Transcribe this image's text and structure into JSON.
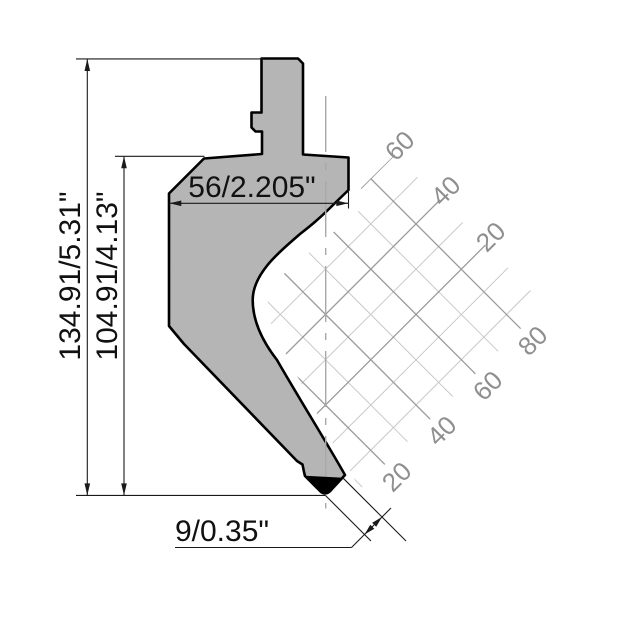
{
  "drawing": {
    "dims": {
      "total_height": "134.91/5.31\"",
      "working_height": "104.91/4.13\"",
      "shoulder_width": "56/2.205\"",
      "tip_dim": "9/0.35\""
    },
    "grid": {
      "ne_labels": [
        "60",
        "40",
        "20"
      ],
      "se_labels": [
        "80",
        "60",
        "40",
        "20"
      ]
    },
    "colors": {
      "punch_fill": "#b5b5b5",
      "outline": "#000000",
      "grid_minor": "#c9c9c9",
      "grid_major": "#9a9a9a",
      "grid_label": "#8f8f8f",
      "centerline": "#a8a8a8",
      "dimension": "#1a1a1a"
    }
  }
}
